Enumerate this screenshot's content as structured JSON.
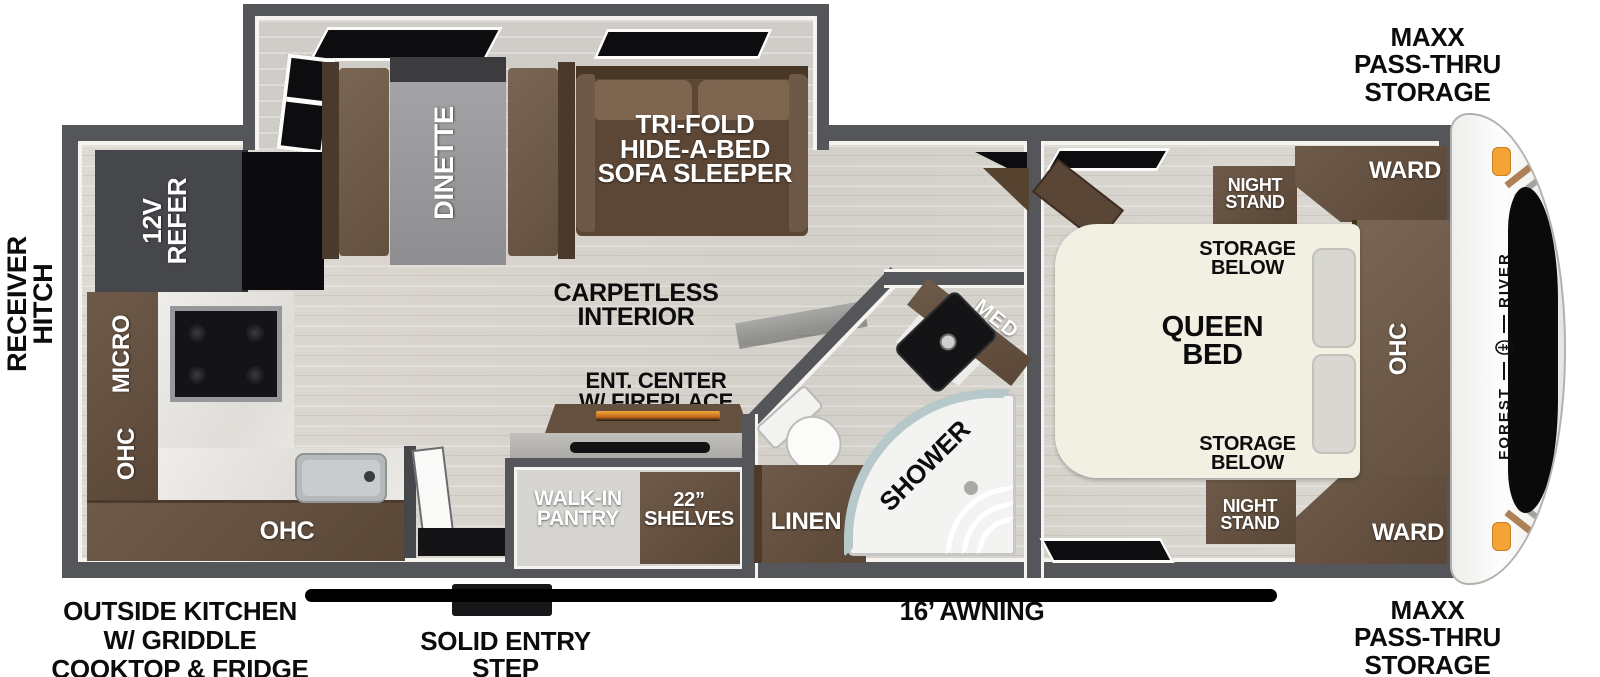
{
  "title": "Travel trailer floor plan",
  "exterior": {
    "receiver_hitch": "RECEIVER\nHITCH",
    "storage_front_top": "MAXX\nPASS-THRU\nSTORAGE",
    "storage_front_bottom": "MAXX\nPASS-THRU\nSTORAGE",
    "outside_kitchen": "OUTSIDE KITCHEN\nW/ GRIDDLE\nCOOKTOP & FRIDGE",
    "entry_step": "SOLID ENTRY\nSTEP",
    "awning": "16’ AWNING",
    "brand_word1": "FOREST",
    "brand_word2": "RIVER"
  },
  "living": {
    "dinette": "DINETTE",
    "sofa": "TRI-FOLD\nHIDE-A-BED\nSOFA SLEEPER",
    "carpetless": "CARPETLESS\nINTERIOR",
    "ent_center": "ENT. CENTER\nW/ FIREPLACE"
  },
  "kitchen": {
    "refer": "12V\nREFER",
    "micro": "MICRO",
    "ohc_upper": "OHC",
    "ohc_lower": "OHC"
  },
  "pantry": {
    "name": "WALK-IN\nPANTRY",
    "shelves": "22”\nSHELVES"
  },
  "bath": {
    "linen": "LINEN",
    "shower": "SHOWER",
    "med": "MED"
  },
  "bedroom": {
    "bed": "QUEEN\nBED",
    "storage_top": "STORAGE\nBELOW",
    "storage_bottom": "STORAGE\nBELOW",
    "night_stand_top": "NIGHT\nSTAND",
    "night_stand_bottom": "NIGHT\nSTAND",
    "ward_top": "WARD",
    "ward_bottom": "WARD",
    "ohc": "OHC"
  },
  "colors": {
    "wall": "#54565a",
    "furniture_brown": "#6e5a49",
    "marker_light_orange": "#f3a435",
    "awning_black": "#000000",
    "fireplace_flame": "#e8931d"
  }
}
